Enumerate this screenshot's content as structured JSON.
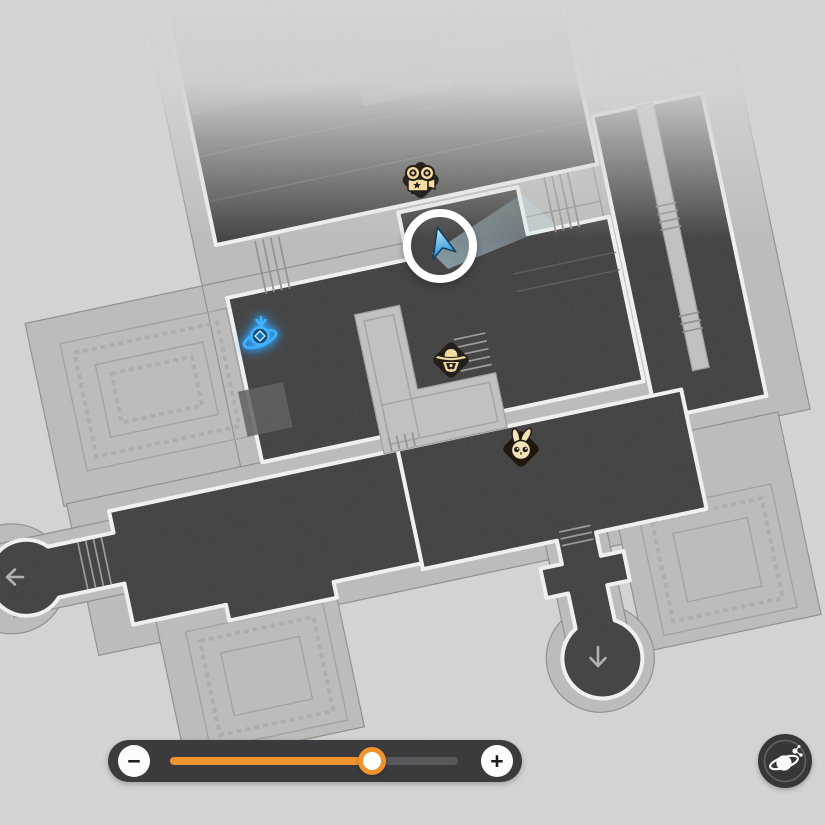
{
  "scene": {
    "type": "game-map-overlay",
    "background_color": "#d6d6d4",
    "floor_color": "#3c3c3c",
    "platform_color": "#bdbdbb",
    "wall_color": "#f5f5f3"
  },
  "map": {
    "markers": [
      {
        "id": "camera-marker",
        "icon": "movie-camera-icon",
        "x": 420,
        "y": 182
      },
      {
        "id": "player-marker",
        "icon": "player-arrow-icon",
        "x": 440,
        "y": 246
      },
      {
        "id": "space-anchor-marker",
        "icon": "space-anchor-icon",
        "x": 261,
        "y": 336,
        "glow_color": "#36a9ff"
      },
      {
        "id": "hat-character-marker",
        "icon": "hat-character-icon",
        "x": 451,
        "y": 361
      },
      {
        "id": "rabbit-character-marker",
        "icon": "rabbit-character-icon",
        "x": 521,
        "y": 449
      },
      {
        "id": "exit-arrow-left",
        "icon": "arrow-left-icon",
        "x": 14,
        "y": 577
      },
      {
        "id": "exit-arrow-down",
        "icon": "arrow-down-icon",
        "x": 598,
        "y": 657
      }
    ]
  },
  "zoom_control": {
    "minus_label": "−",
    "plus_label": "+",
    "value_percent": 70,
    "fill_color": "#f0922e",
    "track_color": "#58585a"
  },
  "planet_button": {
    "icon": "ringed-planet-icon"
  }
}
